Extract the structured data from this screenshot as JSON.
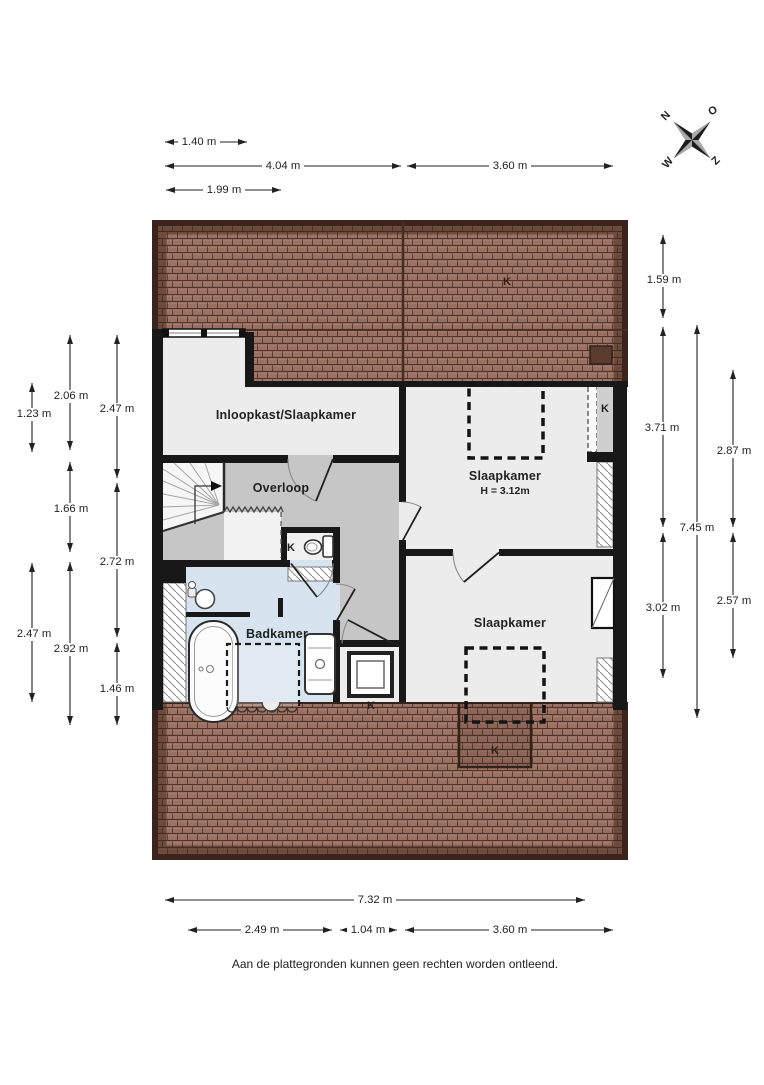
{
  "plan": {
    "rooms": {
      "inloopkast_label": "Inloopkast/Slaapkamer",
      "overloop_label": "Overloop",
      "slaapkamer_top_label": "Slaapkamer",
      "slaapkamer_top_height": "H = 3.12m",
      "badkamer_label": "Badkamer",
      "slaapkamer_bottom_label": "Slaapkamer"
    },
    "k_label": "K",
    "colors": {
      "roof": "#9c7164",
      "roof_edge": "#3a241b",
      "wall": "#181818",
      "floor": "#ececec",
      "landing": "#c6c6c6",
      "bathroom": "#d7e3ee"
    }
  },
  "compass": {
    "north": "N",
    "east": "O",
    "south": "Z",
    "west": "W"
  },
  "dimensions": {
    "top": [
      "1.40 m",
      "4.04 m",
      "3.60 m",
      "1.99 m"
    ],
    "left": [
      "1.23 m",
      "2.47 m",
      "2.06 m",
      "1.66 m",
      "2.92 m",
      "2.47 m",
      "2.72 m",
      "1.46 m"
    ],
    "right": [
      "1.59 m",
      "3.71 m",
      "3.02 m",
      "7.45 m",
      "2.87 m",
      "2.57 m"
    ],
    "bottom": [
      "7.32 m",
      "2.49 m",
      "1.04 m",
      "3.60 m"
    ]
  },
  "footer": {
    "disclaimer": "Aan de plattegronden kunnen geen rechten worden ontleend."
  }
}
